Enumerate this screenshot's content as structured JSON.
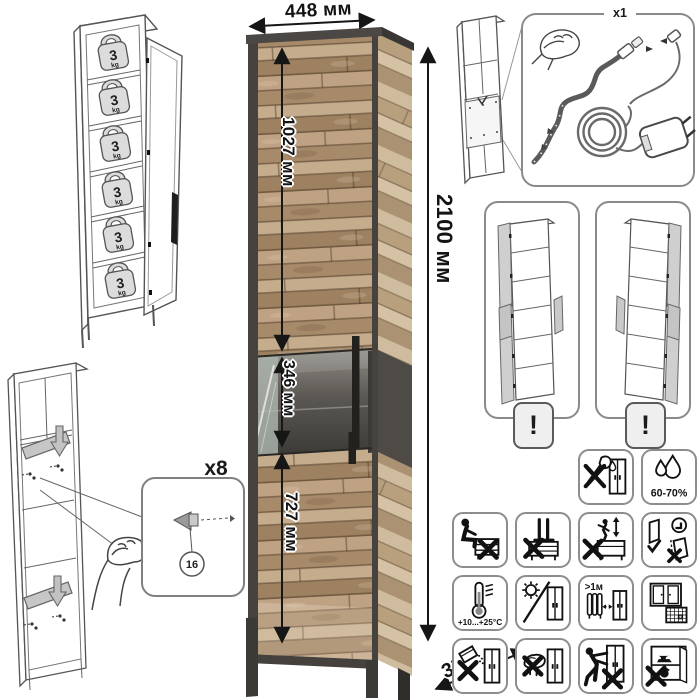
{
  "dims": {
    "width": "448 мм",
    "upper": "1027 мм",
    "middle": "346 мм",
    "lower": "727 мм",
    "height": "2100 мм",
    "depth": "370 мм"
  },
  "load": {
    "value": "3",
    "unit": "kg",
    "shelves": 6
  },
  "assembly": {
    "qty": "x8",
    "part": "16"
  },
  "led": {
    "qty": "x1"
  },
  "options": {
    "warning": "!"
  },
  "care": {
    "humidity": "60-70%",
    "temperature": "+10...+25°C",
    "distance": ">1м",
    "calendar_day": "21"
  },
  "care_icons": [
    "no-sharp-tools",
    "humidity-60-70",
    "no-sitting",
    "no-standing-on-top",
    "no-climbing",
    "door-adjustment",
    "temperature-range",
    "no-direct-sunlight",
    "keep-1m-from-heater",
    "ventilate-room",
    "no-abrasive-cleaners",
    "no-wet-cloth",
    "no-dragging-loaded",
    "no-heavy-objects"
  ],
  "colors": {
    "wood": "#b2977a",
    "frame": "#46433f",
    "glass_back": "#4e4b47",
    "line": "#161616",
    "panel_border": "#8a8a8a"
  }
}
